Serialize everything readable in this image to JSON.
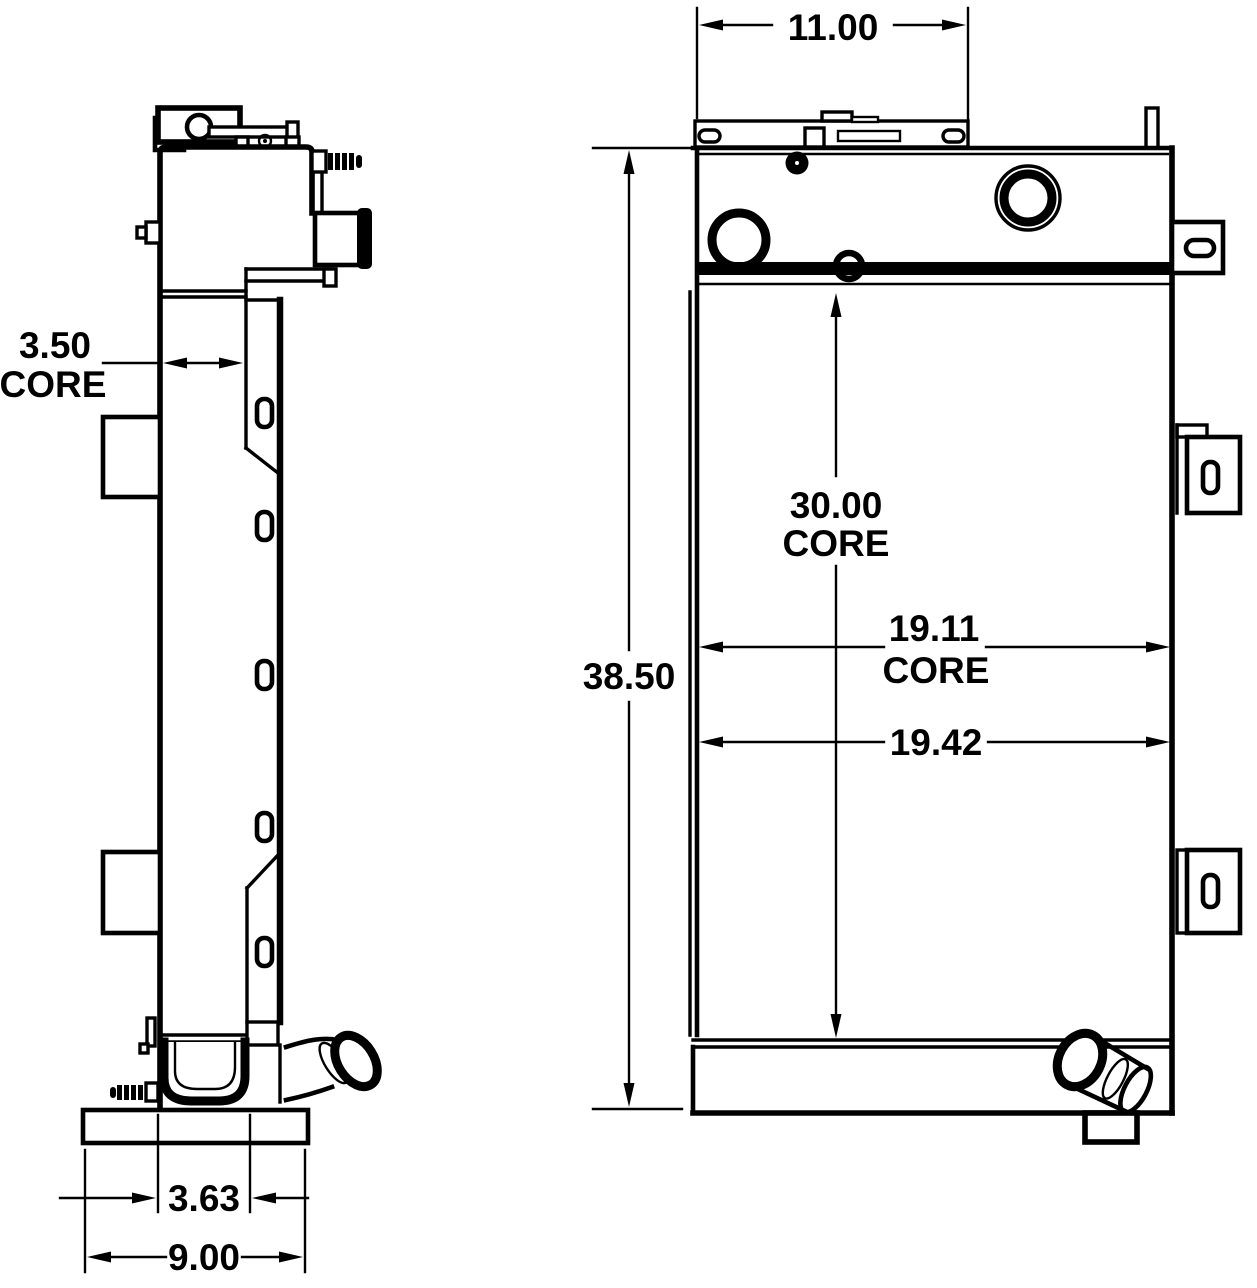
{
  "colors": {
    "background": "#ffffff",
    "line": "#000000"
  },
  "dims": {
    "top_width": {
      "value": "11.00"
    },
    "overall_height": {
      "value": "38.50"
    },
    "core_height": {
      "value": "30.00",
      "label": "CORE"
    },
    "core_width": {
      "value": "19.11",
      "label": "CORE"
    },
    "overall_width": {
      "value": "19.42"
    },
    "core_depth": {
      "value": "3.50",
      "label": "CORE"
    },
    "foot_inset": {
      "value": "3.63"
    },
    "base_width": {
      "value": "9.00"
    }
  }
}
